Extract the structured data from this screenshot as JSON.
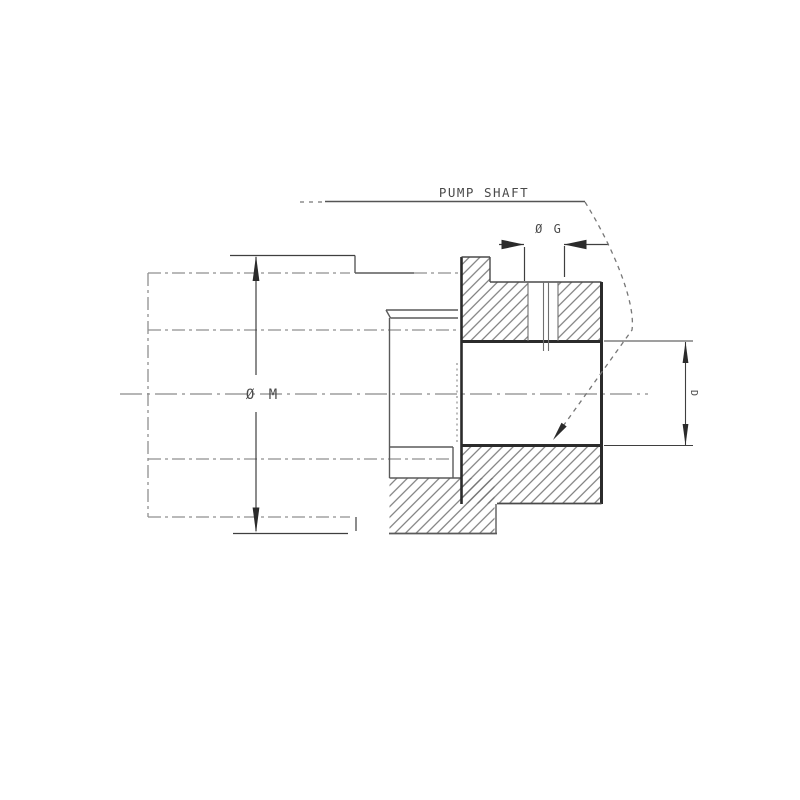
{
  "drawing": {
    "labels": {
      "pump_shaft": "PUMP SHAFT",
      "dia_g": "Ø G",
      "dia_m": "Ø M",
      "dia_d": "D"
    },
    "colors": {
      "outline_heavy": "#2b2b2b",
      "outline_medium": "#4a4a4a",
      "hatch": "#6f6f6f",
      "phantom": "#8f8f8f",
      "dimension": "#3f3f3f",
      "text": "#4a4a4a"
    }
  }
}
